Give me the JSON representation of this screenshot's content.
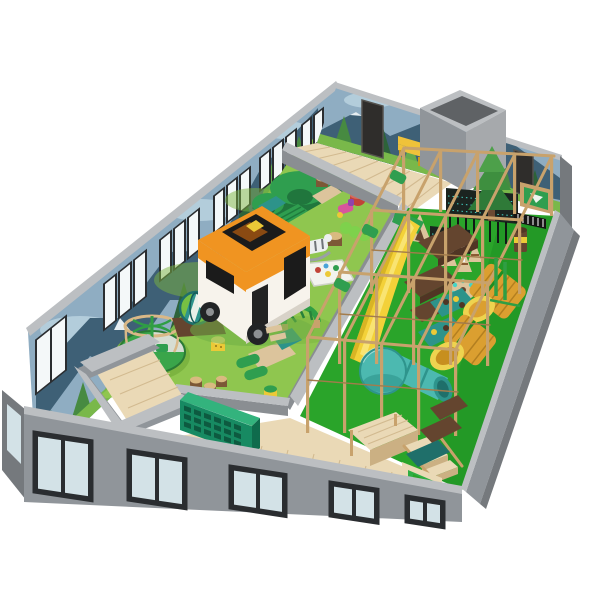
{
  "scene": {
    "label": "3D isometric render of an indoor children's playground floor plan on a white background",
    "background": "#ffffff",
    "zones": {
      "toddler_zone": "toddler soft-play lawn enclosed by low grey walls",
      "play_structure": "two-level wooden-frame adventure play structure on green flooring",
      "corridor": "light wooden walkway along the back mural wall",
      "front_walkway": "light wooden walkway along the front glass wall",
      "entrance_vestibule": "grey entrance vestibule room with wooden floor",
      "storage_room": "grey open-top storage room at the back right"
    },
    "objects": {
      "left_mural_wall": {
        "label": "back-left wall with forest mural and white windows"
      },
      "back_mural_wall": {
        "label": "back-right wall with forest and camping mural, dark doors, yellow bench"
      },
      "front_glass_wall": {
        "label": "front exterior grey wall with glazed windows"
      },
      "right_wall": {
        "label": "right exterior grey wall"
      },
      "camper_van": {
        "label": "orange and white toy camper van"
      },
      "soft_play_mound": {
        "label": "green soft-play mound with crawl arches"
      },
      "carousel": {
        "label": "wooden cage carousel with green seats"
      },
      "hamster_wheel": {
        "label": "teal striped rolling wheel on brown base"
      },
      "climbing_arch": {
        "label": "green arch climber"
      },
      "soft_lounge": {
        "label": "tan and teal soft lounge blocks"
      },
      "stump_stools": {
        "label": "wooden stump stools"
      },
      "smiley_stools": {
        "label": "yellow smiley cylinder stools"
      },
      "play_mat": {
        "label": "white activity play mat"
      },
      "animal_rocker": {
        "label": "grey zebra rocker toy"
      },
      "red_stool": {
        "label": "red cylinder stool"
      },
      "pink_toy": {
        "label": "pink ride-on toy"
      },
      "caterpillar": {
        "label": "green caterpillar soft toy"
      },
      "cubby_shelf": {
        "label": "green cubby storage shelf"
      },
      "yellow_slide": {
        "label": "yellow wavy slide"
      },
      "tube_slide": {
        "label": "teal tube slide with ball-shaped end"
      },
      "crawl_rollers": {
        "label": "orange mesh crawl rollers with yellow rims"
      },
      "netting": {
        "label": "dark safety netting with teal dots"
      },
      "pine_tree_prop": {
        "label": "decorative 3D pine tree"
      },
      "teepee": {
        "label": "small tan teepee tent"
      },
      "cones": {
        "label": "tan obstacle cones"
      },
      "candy_poles": {
        "label": "red and white striped poles"
      },
      "spinner": {
        "label": "spinning wheel panel with teal balls"
      },
      "climb_mats": {
        "label": "teal mesh climbing mats with knobs"
      },
      "stage": {
        "label": "wooden platform stage"
      },
      "stairs": {
        "label": "wooden steps"
      },
      "green_panel": {
        "label": "green activity panel with window"
      },
      "piano_panel": {
        "label": "dark piano-key activity panel"
      },
      "barrel_post": {
        "label": "brown barrel post with yellow band"
      },
      "storage_cube": {
        "label": "grey open-top room cube"
      },
      "doors": {
        "label": "dark doorway panels"
      },
      "bench": {
        "label": "yellow mural bench"
      }
    }
  },
  "colors": {
    "background": "#ffffff",
    "wall_grey": "#90959a",
    "wall_grey_dark": "#75797d",
    "wall_cap": "#bcbfc2",
    "wall_inner_grey": "#8a8e92",
    "mural_sky": "#8fadc2",
    "mural_sky_light": "#b3cddb",
    "mural_mountain": "#3e6076",
    "mural_snow": "#e6eef2",
    "mural_tree_dark": "#2d6339",
    "mural_tree_mid": "#478a41",
    "mural_tree_light": "#64ab4e",
    "mural_grass": "#79b84a",
    "door_dark": "#2f2d2b",
    "bench_yellow": "#efc23a",
    "window_white": "#f4f8f9",
    "glass": "#d3e2e7",
    "frame_dark": "#2a2d30",
    "wood_floor": "#ead9b6",
    "wood_line": "#d2ba90",
    "grass": "#8fc64f",
    "grass_dark": "#7cb440",
    "green_floor": "#2aa42a",
    "green_floor_dark": "#1d8f22",
    "beam": "#c8a26c",
    "beam_dark": "#a37c4c",
    "beam_light": "#e2c493",
    "deck_brown": "#64452f",
    "deck_brown_dark": "#503524",
    "slide_yellow": "#f3d139",
    "slide_yellow_dark": "#d8b424",
    "slide_highlight": "#f9e472",
    "teal": "#4cb9b0",
    "teal_dark": "#2e948c",
    "teal_deep": "#1f6f6a",
    "roller_orange": "#db9f30",
    "roller_rim": "#eed34f",
    "net_dark": "#1b2420",
    "net_dot": "#45d4c6",
    "soft_green": "#2f9e4f",
    "soft_green_dark": "#20763d",
    "soft_teal": "#2d938a",
    "soft_tan": "#dcc49c",
    "camper_orange": "#f09421",
    "camper_white": "#f7f3ec",
    "camper_grey": "#d8d2c8",
    "tire_black": "#222426",
    "shelf_green": "#178a62",
    "shelf_green_light": "#33b37d",
    "shelf_slot": "#0d5a40",
    "stump_brown": "#7c5836",
    "stump_top": "#d9ba80",
    "red_stool": "#c14338",
    "pink_toy": "#d8559c",
    "caterpillar": "#7ed14c",
    "smiley_yellow": "#ecc937",
    "tent_orange": "#e2862f"
  }
}
